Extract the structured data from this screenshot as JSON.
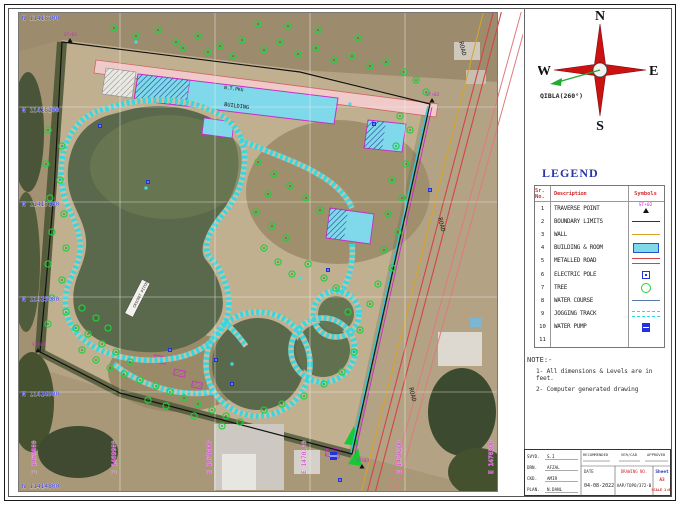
{
  "drawing": {
    "compass": {
      "n": "N",
      "s": "S",
      "e": "E",
      "w": "W",
      "qibla_label": "QIBLA(260°)"
    },
    "legend": {
      "title": "LEGEND",
      "columns": [
        "Sr. No.",
        "Description",
        "Symbols"
      ],
      "traverse_symbol_label": "ST+02",
      "rows": [
        {
          "no": "1",
          "desc": "TRAVERSE POINT",
          "symbol": "traverse"
        },
        {
          "no": "2",
          "desc": "BOUNDARY LIMITS",
          "symbol": "boundary"
        },
        {
          "no": "3",
          "desc": "WALL",
          "symbol": "wall"
        },
        {
          "no": "4",
          "desc": "BUILDING & ROOM",
          "symbol": "building"
        },
        {
          "no": "5",
          "desc": "METALLED ROAD",
          "symbol": "road"
        },
        {
          "no": "6",
          "desc": "ELECTRIC POLE",
          "symbol": "pole"
        },
        {
          "no": "7",
          "desc": "TREE",
          "symbol": "tree"
        },
        {
          "no": "8",
          "desc": "WATER COURSE",
          "symbol": "water"
        },
        {
          "no": "9",
          "desc": "JOGGING TRACK",
          "symbol": "track"
        },
        {
          "no": "10",
          "desc": "WATER PUMP",
          "symbol": "pump"
        },
        {
          "no": "11",
          "desc": "",
          "symbol": "none"
        }
      ]
    },
    "notes": {
      "title": "NOTE:-",
      "items": [
        "1- All dimensions & Levels are in feet.",
        "2- Computer generated drawing"
      ]
    },
    "titleblock": {
      "rows": [
        {
          "label": "SVYD.",
          "value": "S.I"
        },
        {
          "label": "DRN.",
          "value": "AFZAL"
        },
        {
          "label": "CKD.",
          "value": "AMIR"
        },
        {
          "label": "PLAN.",
          "value": "N.DANL"
        }
      ],
      "recommended": "RECOMMENDED",
      "vercad": "VER/CAD",
      "approved": "APPROVED",
      "date_label": "DATE",
      "date": "04-08-2022",
      "drawing_no_label": "DRAWING NO.",
      "drawing_no": "AAP/TOPO/372-B",
      "sheet_label": "Sheet",
      "sheet": "A3",
      "scale": "SCALE 1:80"
    },
    "map": {
      "grid": {
        "vx": [
          102,
          197,
          292,
          387
        ],
        "hy": [
          95,
          190,
          285,
          380
        ]
      },
      "northings": [
        {
          "label": "N 11415300",
          "y": 8
        },
        {
          "label": "N 11415200",
          "y": 100
        },
        {
          "label": "N 11415100",
          "y": 194
        },
        {
          "label": "N 11415000",
          "y": 289
        },
        {
          "label": "N 11414900",
          "y": 384
        },
        {
          "label": "N 11414800",
          "y": 476
        }
      ],
      "eastings": [
        {
          "label": "E 1469800",
          "x": 20
        },
        {
          "label": "E 1469900",
          "x": 100
        },
        {
          "label": "E 1470000",
          "x": 195
        },
        {
          "label": "E 1470100",
          "x": 290
        },
        {
          "label": "E 1470200",
          "x": 385
        },
        {
          "label": "E 1470300",
          "x": 477
        }
      ],
      "road_labels": [
        {
          "text": "ROAD",
          "x": 441,
          "y": 30,
          "rot": 76
        },
        {
          "text": "ROAD",
          "x": 420,
          "y": 206,
          "rot": 76
        },
        {
          "text": "ROAD",
          "x": 391,
          "y": 376,
          "rot": 76
        }
      ],
      "feature_labels": [
        {
          "text": "B.T.PKG",
          "x": 206,
          "y": 77,
          "rot": 7,
          "size": 4.6
        },
        {
          "text": "BUILDING",
          "x": 206,
          "y": 94,
          "rot": 7,
          "size": 5.2
        },
        {
          "text": "CRICKET PITCH",
          "x": 117,
          "y": 296,
          "rot": -63,
          "size": 3.6
        }
      ],
      "traverse_points": [
        {
          "label": "ST+01",
          "x": 46,
          "y": 24
        },
        {
          "label": "ST+02",
          "x": 408,
          "y": 84
        },
        {
          "label": "ST+03",
          "x": 338,
          "y": 450
        },
        {
          "label": "ST+04",
          "x": 14,
          "y": 334
        }
      ],
      "trees": [
        [
          96,
          16
        ],
        [
          118,
          24
        ],
        [
          140,
          18
        ],
        [
          158,
          30
        ],
        [
          180,
          24
        ],
        [
          202,
          34
        ],
        [
          224,
          28
        ],
        [
          246,
          38
        ],
        [
          262,
          30
        ],
        [
          280,
          42
        ],
        [
          298,
          36
        ],
        [
          316,
          48
        ],
        [
          334,
          44
        ],
        [
          352,
          54
        ],
        [
          368,
          50
        ],
        [
          386,
          60
        ],
        [
          398,
          68
        ],
        [
          408,
          80
        ],
        [
          270,
          14
        ],
        [
          300,
          18
        ],
        [
          240,
          12
        ],
        [
          340,
          26
        ],
        [
          215,
          44
        ],
        [
          190,
          40
        ],
        [
          165,
          36
        ],
        [
          382,
          104
        ],
        [
          392,
          118
        ],
        [
          378,
          134
        ],
        [
          388,
          152
        ],
        [
          374,
          168
        ],
        [
          384,
          186
        ],
        [
          370,
          202
        ],
        [
          380,
          220
        ],
        [
          366,
          238
        ],
        [
          374,
          256
        ],
        [
          360,
          272
        ],
        [
          352,
          292
        ],
        [
          240,
          150
        ],
        [
          256,
          162
        ],
        [
          272,
          174
        ],
        [
          288,
          186
        ],
        [
          302,
          198
        ],
        [
          250,
          182
        ],
        [
          238,
          200
        ],
        [
          254,
          214
        ],
        [
          268,
          226
        ],
        [
          246,
          236
        ],
        [
          260,
          250
        ],
        [
          274,
          262
        ],
        [
          290,
          252
        ],
        [
          306,
          266
        ],
        [
          318,
          276
        ],
        [
          30,
          118
        ],
        [
          44,
          134
        ],
        [
          28,
          152
        ],
        [
          42,
          168
        ],
        [
          32,
          186
        ],
        [
          46,
          202
        ],
        [
          34,
          220
        ],
        [
          48,
          236
        ],
        [
          30,
          252
        ],
        [
          44,
          268
        ],
        [
          34,
          286
        ],
        [
          48,
          300
        ],
        [
          30,
          312
        ],
        [
          64,
          296
        ],
        [
          78,
          306
        ],
        [
          90,
          316
        ],
        [
          70,
          322
        ],
        [
          84,
          332
        ],
        [
          98,
          340
        ],
        [
          64,
          338
        ],
        [
          78,
          348
        ],
        [
          92,
          356
        ],
        [
          106,
          362
        ],
        [
          58,
          316
        ],
        [
          112,
          350
        ],
        [
          122,
          368
        ],
        [
          138,
          374
        ],
        [
          152,
          380
        ],
        [
          166,
          386
        ],
        [
          180,
          392
        ],
        [
          194,
          398
        ],
        [
          208,
          404
        ],
        [
          222,
          410
        ],
        [
          130,
          388
        ],
        [
          148,
          394
        ],
        [
          176,
          404
        ],
        [
          204,
          414
        ],
        [
          330,
          300
        ],
        [
          342,
          318
        ],
        [
          336,
          340
        ],
        [
          324,
          360
        ],
        [
          306,
          372
        ],
        [
          286,
          384
        ],
        [
          264,
          392
        ],
        [
          246,
          398
        ]
      ],
      "poles": [
        [
          82,
          114
        ],
        [
          130,
          170
        ],
        [
          198,
          348
        ],
        [
          214,
          372
        ],
        [
          356,
          112
        ],
        [
          412,
          178
        ],
        [
          310,
          258
        ],
        [
          152,
          338
        ],
        [
          322,
          468
        ]
      ],
      "water_points": [
        [
          128,
          176
        ],
        [
          282,
          266
        ],
        [
          214,
          352
        ],
        [
          118,
          30
        ],
        [
          332,
          92
        ]
      ]
    },
    "colors": {
      "building_fill": "#7fd9ea",
      "magenta": "#c92bc9",
      "tree_green": "#1fd13c",
      "track_cyan": "#2fd8e4",
      "road_red": "#d44444",
      "wall_yellow": "#d9a521",
      "grid_blue": "#2b2bd0",
      "legend_red": "#cf2f2f",
      "legend_blue": "#2b35a8"
    }
  }
}
